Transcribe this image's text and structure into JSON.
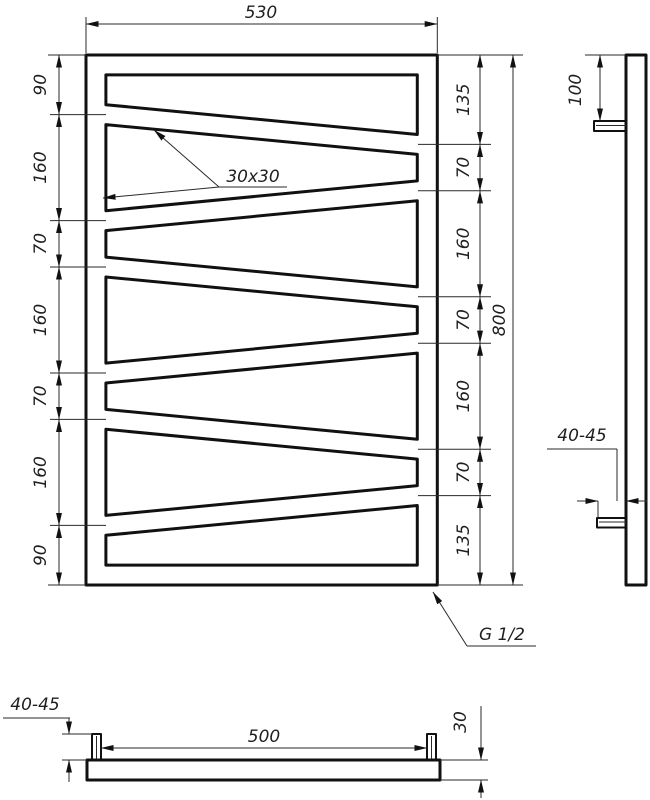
{
  "drawing": {
    "front": {
      "width_label": "530",
      "height_label": "800",
      "left_chain": [
        "90",
        "160",
        "70",
        "160",
        "70",
        "160",
        "90"
      ],
      "right_chain": [
        "135",
        "70",
        "160",
        "70",
        "160",
        "70",
        "135"
      ],
      "tube_label": "30x30",
      "thread_label": "G 1/2"
    },
    "side": {
      "bracket_offset_label": "100",
      "wall_distance_label": "40-45"
    },
    "bottom": {
      "bracket_spacing_label": "500",
      "tube_size_label": "30",
      "wall_distance_label": "40-45"
    },
    "colors": {
      "line": "#111111",
      "background": "#ffffff"
    }
  }
}
